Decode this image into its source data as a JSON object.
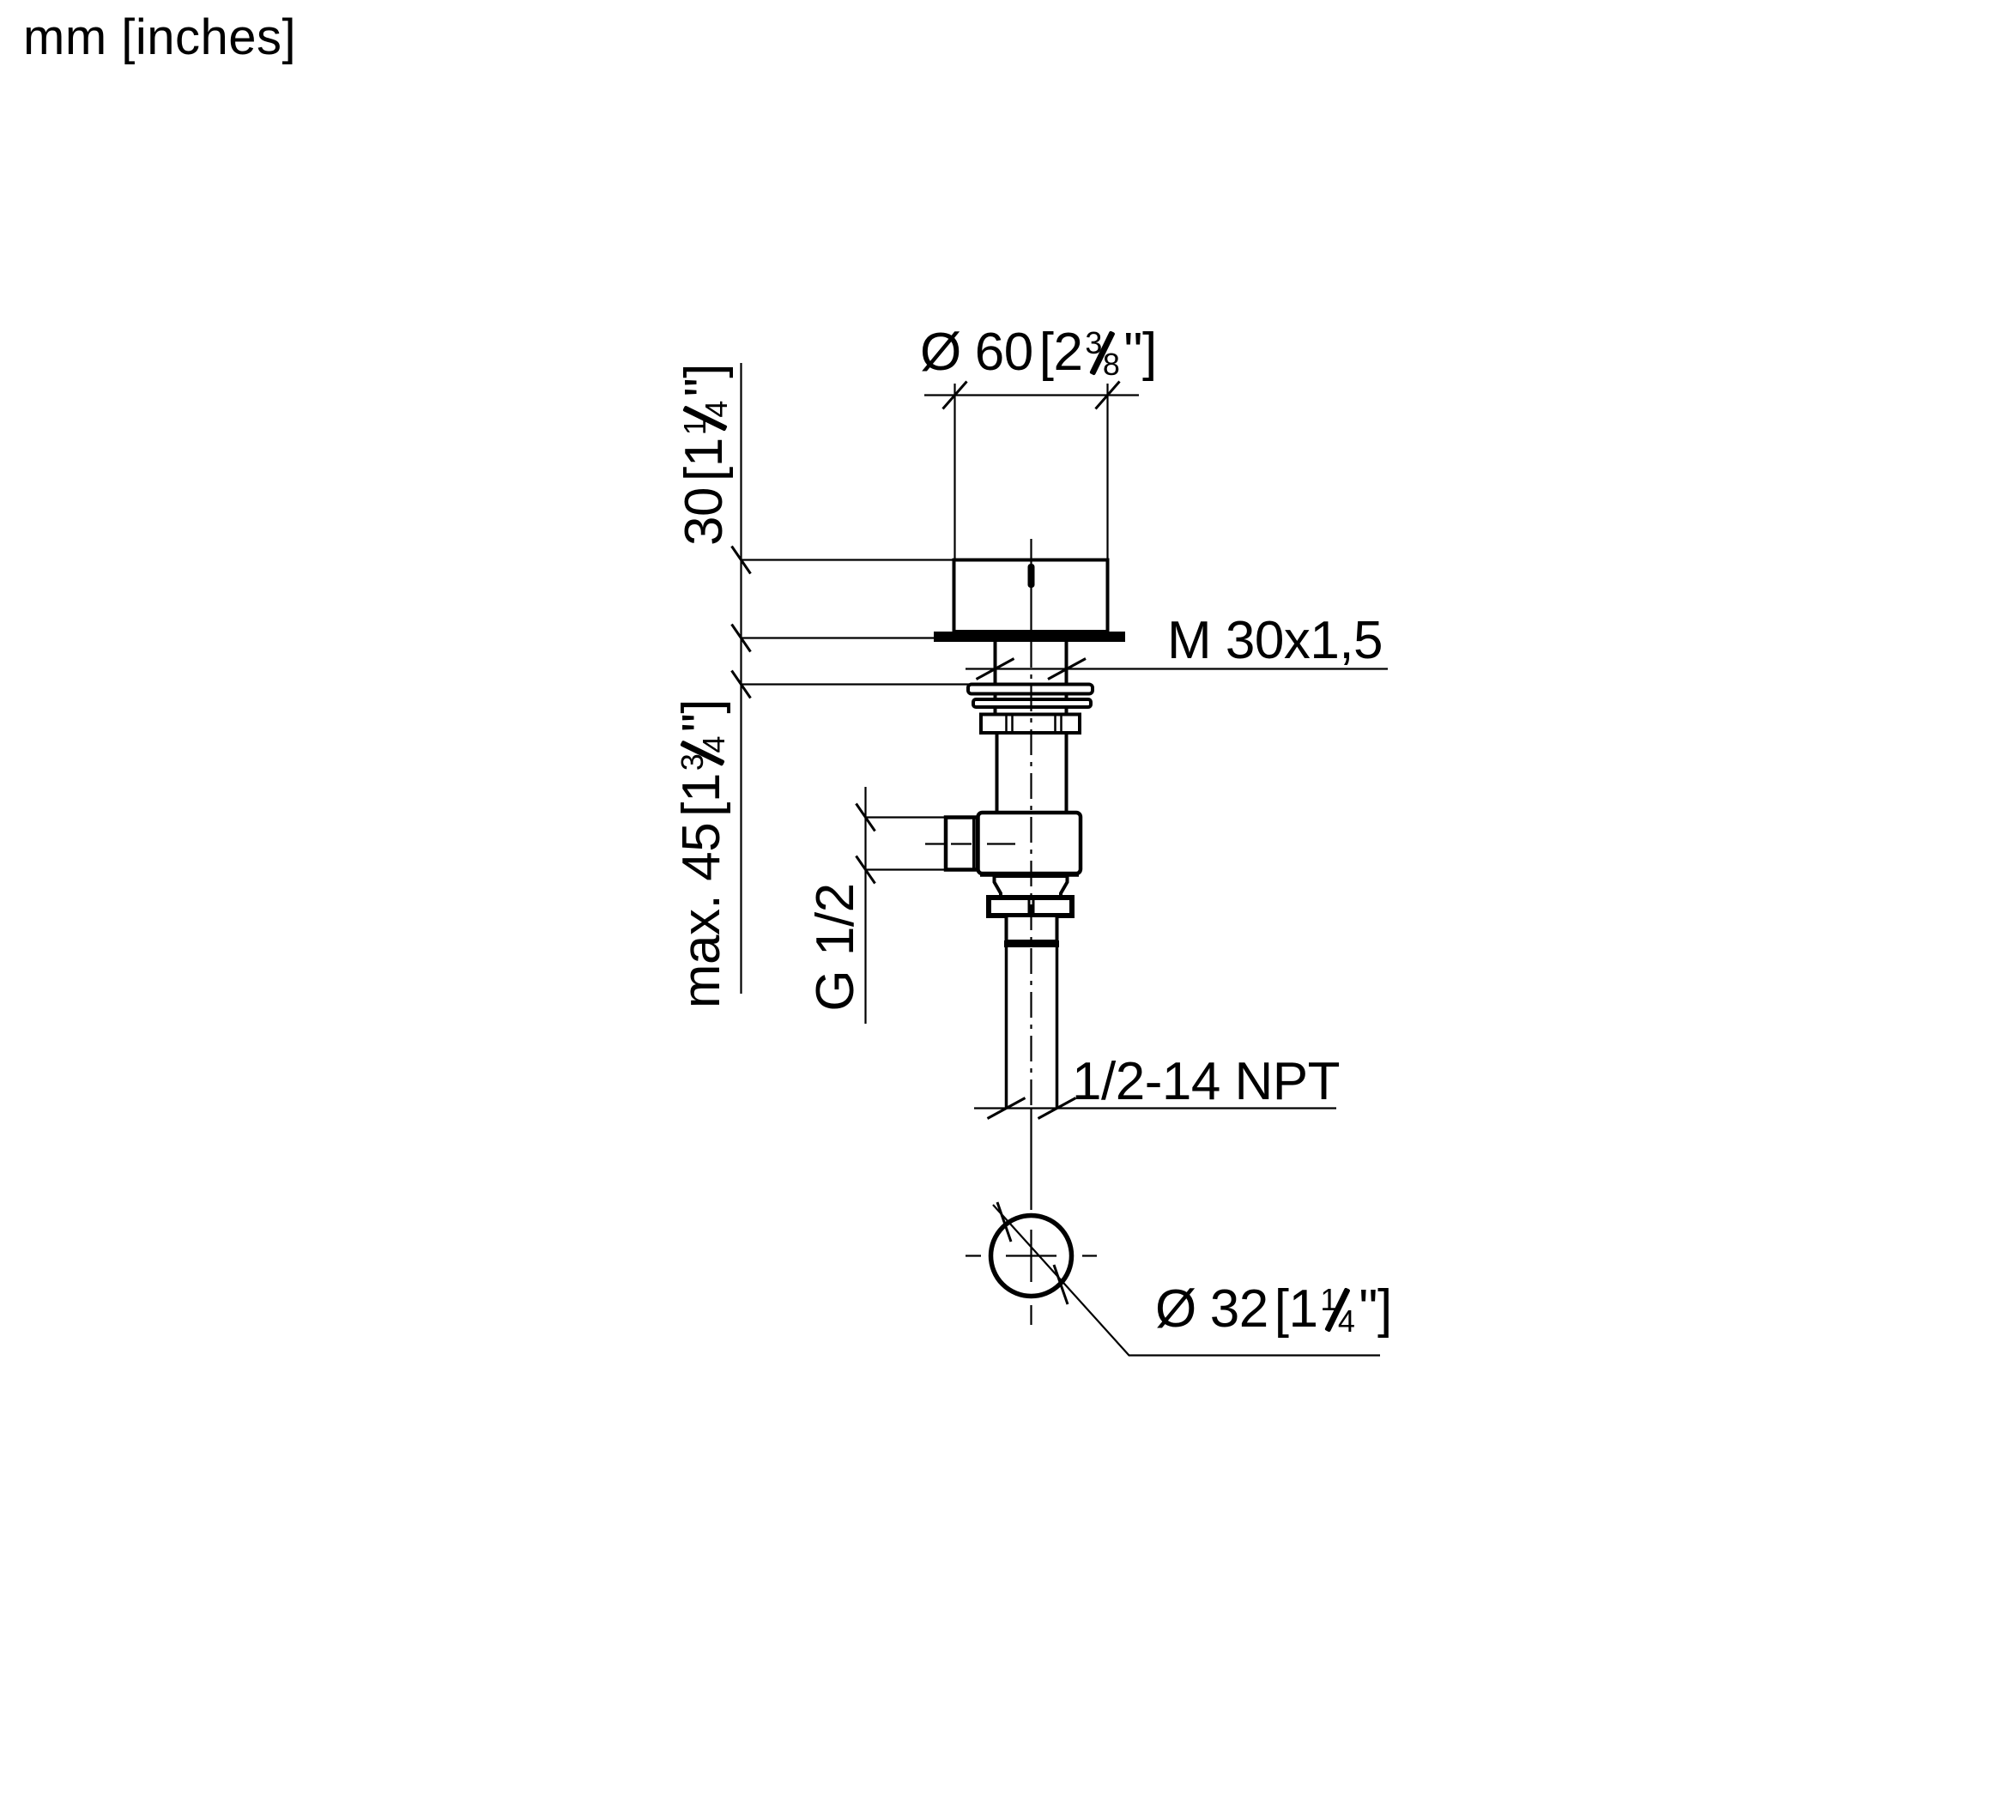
{
  "theme": {
    "ink": "#000000",
    "paper": "#ffffff"
  },
  "meta": {
    "units_note": "mm [inches]"
  },
  "labels": {
    "dia_top": {
      "symbol": "Ø",
      "mm": "60",
      "open": "[",
      "whole": "2",
      "num": "3",
      "den": "8",
      "inch": "\"",
      "close": "]"
    },
    "knob_height": {
      "mm": "30",
      "open": "[",
      "whole": "1",
      "num": "1",
      "den": "4",
      "inch": "\"",
      "close": "]"
    },
    "max_depth": {
      "prefix": "max.",
      "mm": "45",
      "open": "[",
      "whole": "1",
      "num": "3",
      "den": "4",
      "inch": "\"",
      "close": "]"
    },
    "side_thread": {
      "text": "G 1/2"
    },
    "mount_thread": {
      "text": "M 30x1,5"
    },
    "pipe_thread": {
      "text": "1/2-14 NPT"
    },
    "drain_dia": {
      "symbol": "Ø",
      "mm": "32",
      "open": "[",
      "whole": "1",
      "num": "1",
      "den": "4",
      "inch": "\"",
      "close": "]"
    }
  }
}
